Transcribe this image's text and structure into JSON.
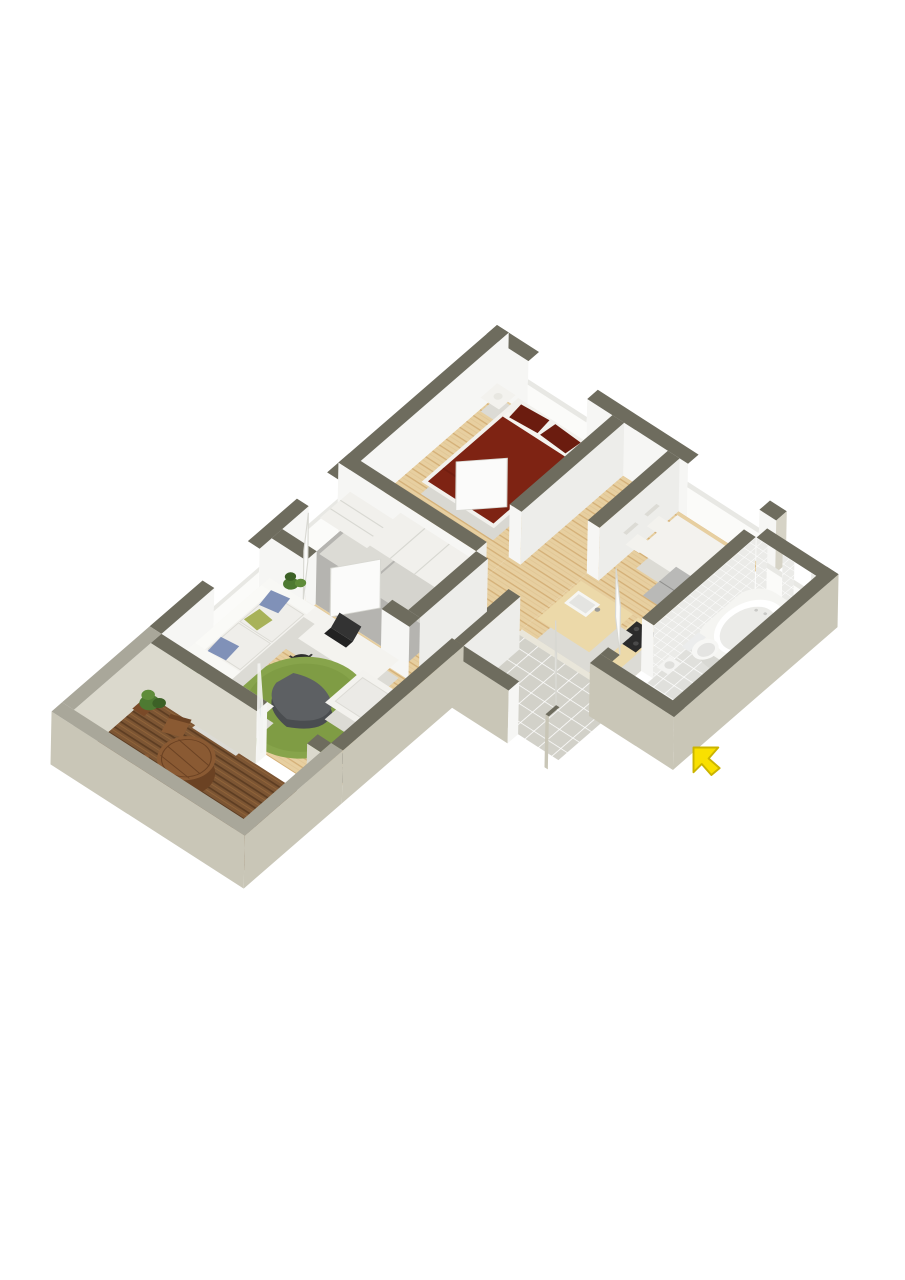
{
  "scene": {
    "type": "3d-floor-plan-render",
    "view": "isometric-birds-eye",
    "background": "#ffffff",
    "text_labels": []
  },
  "palette": {
    "wallCap": "#6e6c5e",
    "wallCapLight": "#a9a79a",
    "wallExt": "#c9c6b7",
    "wallExtLight": "#d6d3c6",
    "wallInt": "#f6f6f4",
    "wallIntShade": "#ededea",
    "balcInt": "#dbd9cd",
    "wood": "#e7cfa0",
    "woodStripe": "#d4b078",
    "deck": "#7c5533",
    "deckStripe": "#5d3d22",
    "deckLight": "#916439",
    "closetFloor": "#b5b4b0",
    "tileEntry": "#d2d1c9",
    "tileBath": "#e0e0dc",
    "tileWall": "#ebebe8",
    "grout": "#ffffff",
    "bedMaroon": "#7e2313",
    "bedMaroonDark": "#6b1c0f",
    "white": "#f3f2ee",
    "whiteShade": "#dcdbd5",
    "sill": "#fbfbf9",
    "sillCap": "#e8e8e4",
    "green": "#87a44b",
    "greenDark": "#75923c",
    "plant": "#4e7a32",
    "plantDark": "#3c6126",
    "gray": "#5d6063",
    "grayDark": "#4a4d50",
    "black": "#242424",
    "counterTop": "#ecd9a9",
    "woodBrown": "#8a5a33",
    "woodBrownDark": "#6b4223",
    "yellow": "#f9e000",
    "yellowDark": "#cbb400",
    "glass": "#ccd7da",
    "cabGray": "#b9b9b7",
    "cabGrayDark": "#9fa09e"
  },
  "rooms": [
    {
      "name": "bedroom",
      "floor": "light-oak-planks",
      "furniture": [
        "double-bed-dark-red-bedding",
        "pillow",
        "pillow",
        "nightstand-left",
        "nightstand-right",
        "table-lamp",
        "table-lamp"
      ],
      "features": [
        "window-northeast",
        "door-to-hallway"
      ]
    },
    {
      "name": "hallway",
      "floor": "light-oak-planks",
      "furniture": [],
      "features": []
    },
    {
      "name": "walk-in-closet",
      "floor": "gray",
      "furniture": [
        "wardrobe-white",
        "shelving-unit-white"
      ],
      "features": [
        "window-northwest",
        "double-doors-to-living-area"
      ]
    },
    {
      "name": "living-room",
      "floor": "light-oak-planks",
      "furniture": [
        "white-sofa",
        "throw-pillows-blue-green",
        "armchair-white",
        "armchair-white",
        "round-green-rug",
        "gray-coffee-table",
        "desk-white",
        "laptop-black",
        "office-chair-black",
        "tv-black-lowboard",
        "media-unit-white",
        "media-unit-white",
        "potted-plant",
        "potted-plant"
      ],
      "features": [
        "window-northwest",
        "glass-door-to-balcony"
      ]
    },
    {
      "name": "dining-kitchen",
      "floor": "light-oak-planks",
      "furniture": [
        "dining-table-white",
        "dining-chair-white",
        "dining-chair-white",
        "dining-chair-white",
        "dining-chair-white",
        "kitchen-island-with-sink",
        "counter-with-cooktop",
        "tall-cabinet-gray"
      ],
      "features": [
        "window-northeast"
      ]
    },
    {
      "name": "bathroom",
      "floor": "white-tile",
      "furniture": [
        "corner-bathtub",
        "toilet",
        "washbasin"
      ],
      "features": [
        "tiled-walls",
        "two-windows",
        "door-to-entry"
      ]
    },
    {
      "name": "entry-hall",
      "floor": "gray-tile",
      "furniture": [],
      "features": [
        "entrance-door"
      ]
    },
    {
      "name": "balcony",
      "floor": "dark-wood-decking",
      "furniture": [
        "round-outdoor-table",
        "outdoor-chair",
        "outdoor-chair",
        "outdoor-chair",
        "potted-plant"
      ],
      "features": [
        "parapet-walls"
      ]
    }
  ],
  "annotations": {
    "entrance_arrow": {
      "shape": "cursor-arrow",
      "color": "#f9e000",
      "points_to": "entrance-door",
      "position": "outside-southeast"
    }
  }
}
